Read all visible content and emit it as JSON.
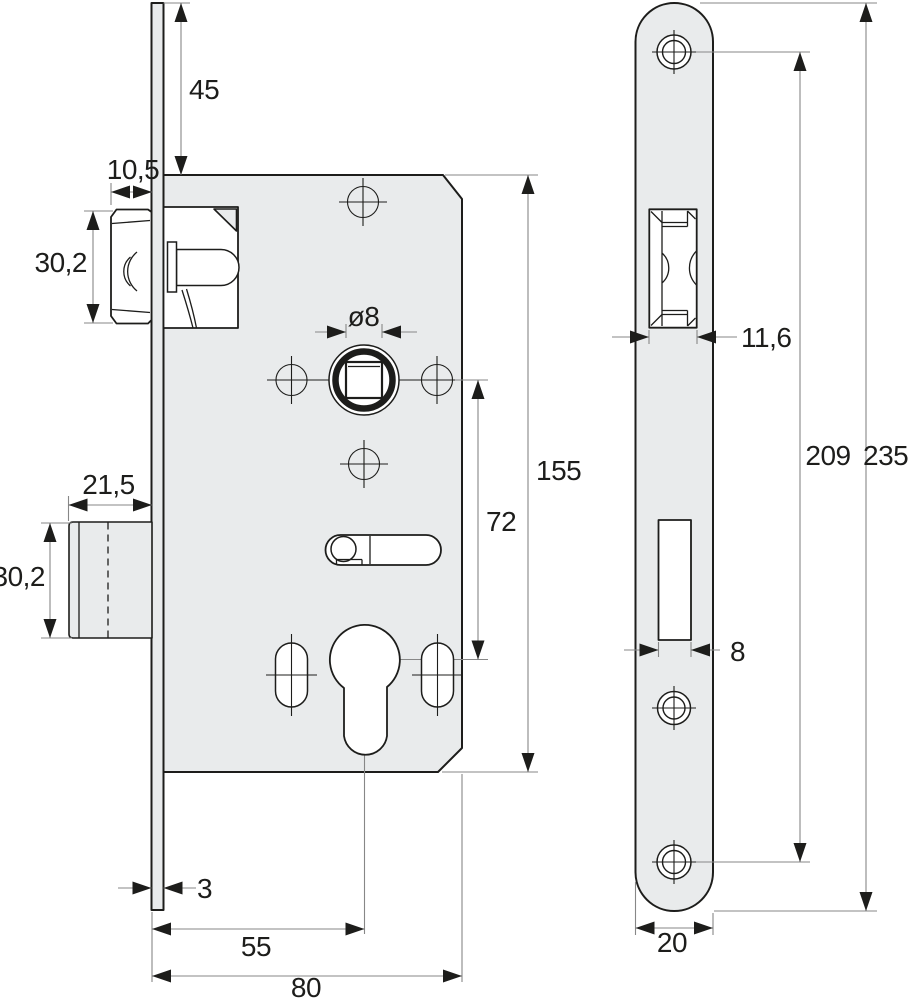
{
  "drawing": {
    "subject": "mortise-lock dimensional drawing",
    "front_view": {
      "dims": {
        "faceplate_top_to_case": "45",
        "latch_protrusion": "10,5",
        "latch_height": "30,2",
        "spindle_square": "ø8",
        "deadbolt_throw": "21,5",
        "deadbolt_height": "30,2",
        "case_height": "155",
        "spindle_to_cylinder": "72",
        "faceplate_thickness": "3",
        "backset": "55",
        "case_depth": "80"
      }
    },
    "side_view": {
      "dims": {
        "latch_cutout_width": "11,6",
        "screw_hole_spacing": "209",
        "faceplate_length": "235",
        "deadbolt_cutout_width": "8",
        "faceplate_width": "20"
      }
    },
    "colors": {
      "background": "#ffffff",
      "part_fill": "#e9ebec",
      "outline": "#1d1d1b",
      "dimension_line": "#878787",
      "arrow": "#1d1d1b"
    }
  }
}
